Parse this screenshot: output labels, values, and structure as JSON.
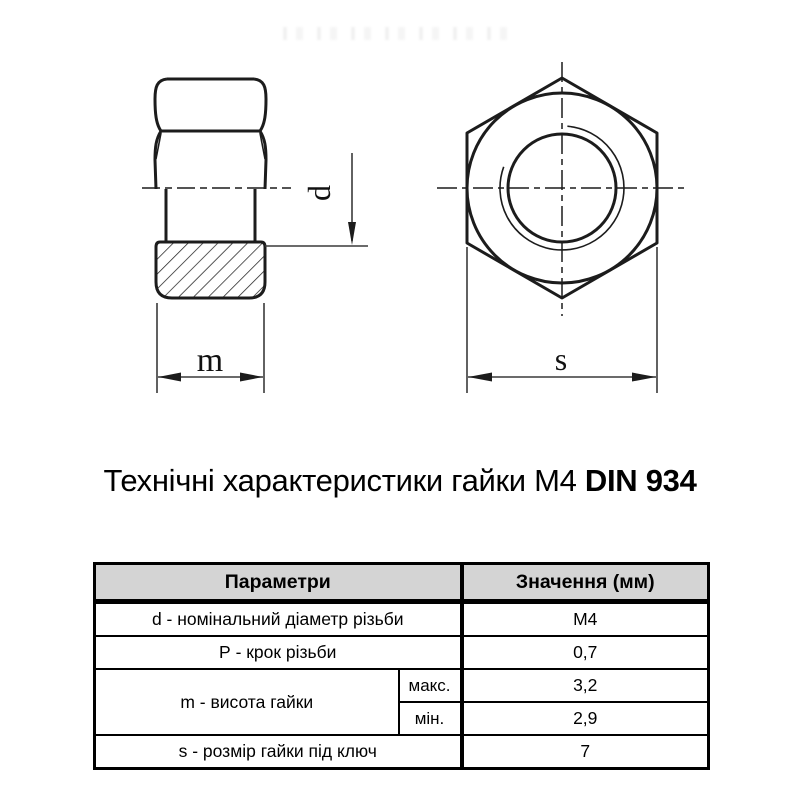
{
  "title": {
    "regular": "Технічні характеристики гайки М4 ",
    "bold": "DIN 934"
  },
  "drawing": {
    "labels": {
      "d": "d",
      "m": "m",
      "s": "s"
    }
  },
  "table": {
    "header": {
      "param": "Параметри",
      "value": "Значення (мм)"
    },
    "rows": {
      "d": {
        "label": "d - номінальний діаметр різьби",
        "value": "М4"
      },
      "p": {
        "label": "Р - крок різьби",
        "value": "0,7"
      },
      "m": {
        "label": "m - висота гайки",
        "max_label": "макс.",
        "max_value": "3,2",
        "min_label": "мін.",
        "min_value": "2,9"
      },
      "s": {
        "label": "s - розмір гайки під ключ",
        "value": "7"
      }
    }
  },
  "colors": {
    "line": "#1c1c1c",
    "dim_line": "#3a3a3a",
    "header_bg": "#d4d4d4",
    "text": "#000000"
  }
}
